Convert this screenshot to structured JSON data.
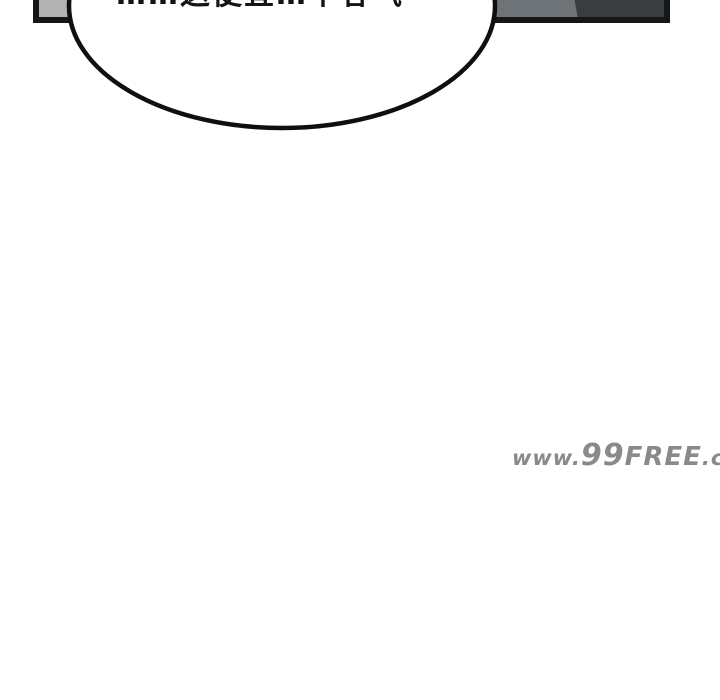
{
  "page": {
    "width": 720,
    "height": 700,
    "background": "#ffffff"
  },
  "panel": {
    "border_color": "#161616",
    "left_fill": "#b2b2b2",
    "edge_fill": "#9aa0a2",
    "mid_fill": "#6e7377",
    "dark_fill": "#3a3d40"
  },
  "bubble": {
    "fill": "#ffffff",
    "stroke": "#0f0f0f",
    "text": "……这便宜…不客气"
  },
  "watermark": {
    "full": "www.99FREE.cc",
    "prefix": "www.",
    "number": "99",
    "name": "FREE",
    "suffix": ".cc",
    "color": "#8a8a8a"
  }
}
